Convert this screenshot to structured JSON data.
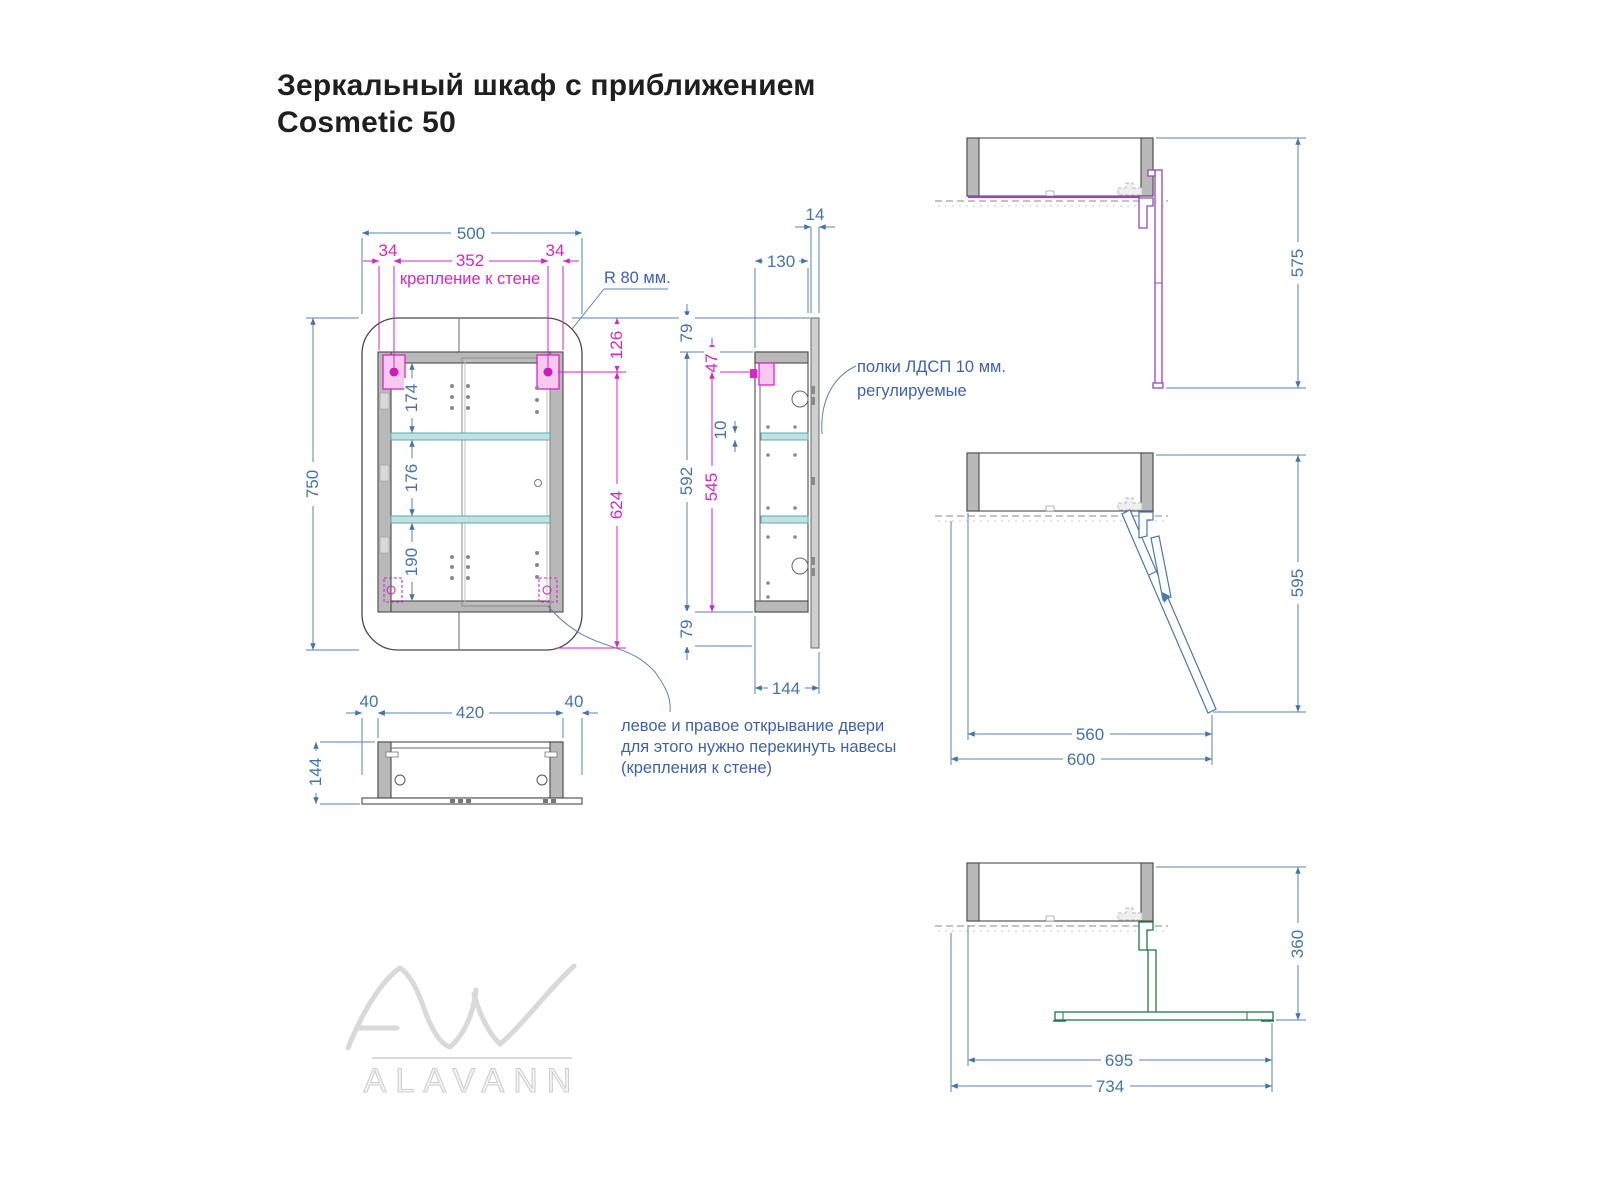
{
  "title": {
    "line1": "Зеркальный шкаф с приближением",
    "line2": "Cosmetic 50"
  },
  "views": {
    "front": {
      "dims": {
        "width": "500",
        "hinge_inset_left": "34",
        "hinge_span": "352",
        "hinge_inset_right": "34",
        "height": "750",
        "top_to_hinge": "126",
        "hinge_to_bottom": "624",
        "section_top": "174",
        "section_middle": "176",
        "section_bottom": "190"
      },
      "labels": {
        "wall_mount": "крепление к стене",
        "corner_radius": "R 80 мм."
      }
    },
    "side": {
      "dims": {
        "door_thickness": "14",
        "depth": "130",
        "top_overhang": "79",
        "hinge_offset": "47",
        "shelf_thickness": "10",
        "box_height": "592",
        "inner_height": "545",
        "bottom_overhang": "79",
        "total_depth": "144"
      },
      "labels": {
        "shelves_line1": "полки ЛДСП 10 мм.",
        "shelves_line2": "регулируемые"
      }
    },
    "bottom": {
      "dims": {
        "edge_left": "40",
        "inner_width": "420",
        "edge_right": "40",
        "height": "144"
      }
    },
    "open90": {
      "dims": {
        "extent": "575"
      }
    },
    "open45": {
      "dims": {
        "extent": "595",
        "to_tip": "560",
        "total": "600"
      }
    },
    "open180": {
      "dims": {
        "extent": "360",
        "to_tip": "695",
        "total": "734"
      }
    }
  },
  "notes": {
    "door": {
      "line1": "левое и правое открывание двери",
      "line2": "для этого нужно перекинуть навесы",
      "line3": "(крепления к стене)"
    }
  },
  "logo": {
    "brand": "ALAVANN"
  },
  "colors": {
    "dimension_blue": "#4473ad",
    "dimension_magenta": "#d426c6",
    "shelf_teal": "#c0e2e2",
    "wall_gray": "#b9b9b9",
    "door_open_purple": "#9646bd",
    "door_open_blue": "#4878b0",
    "door_open_green": "#20784a"
  }
}
